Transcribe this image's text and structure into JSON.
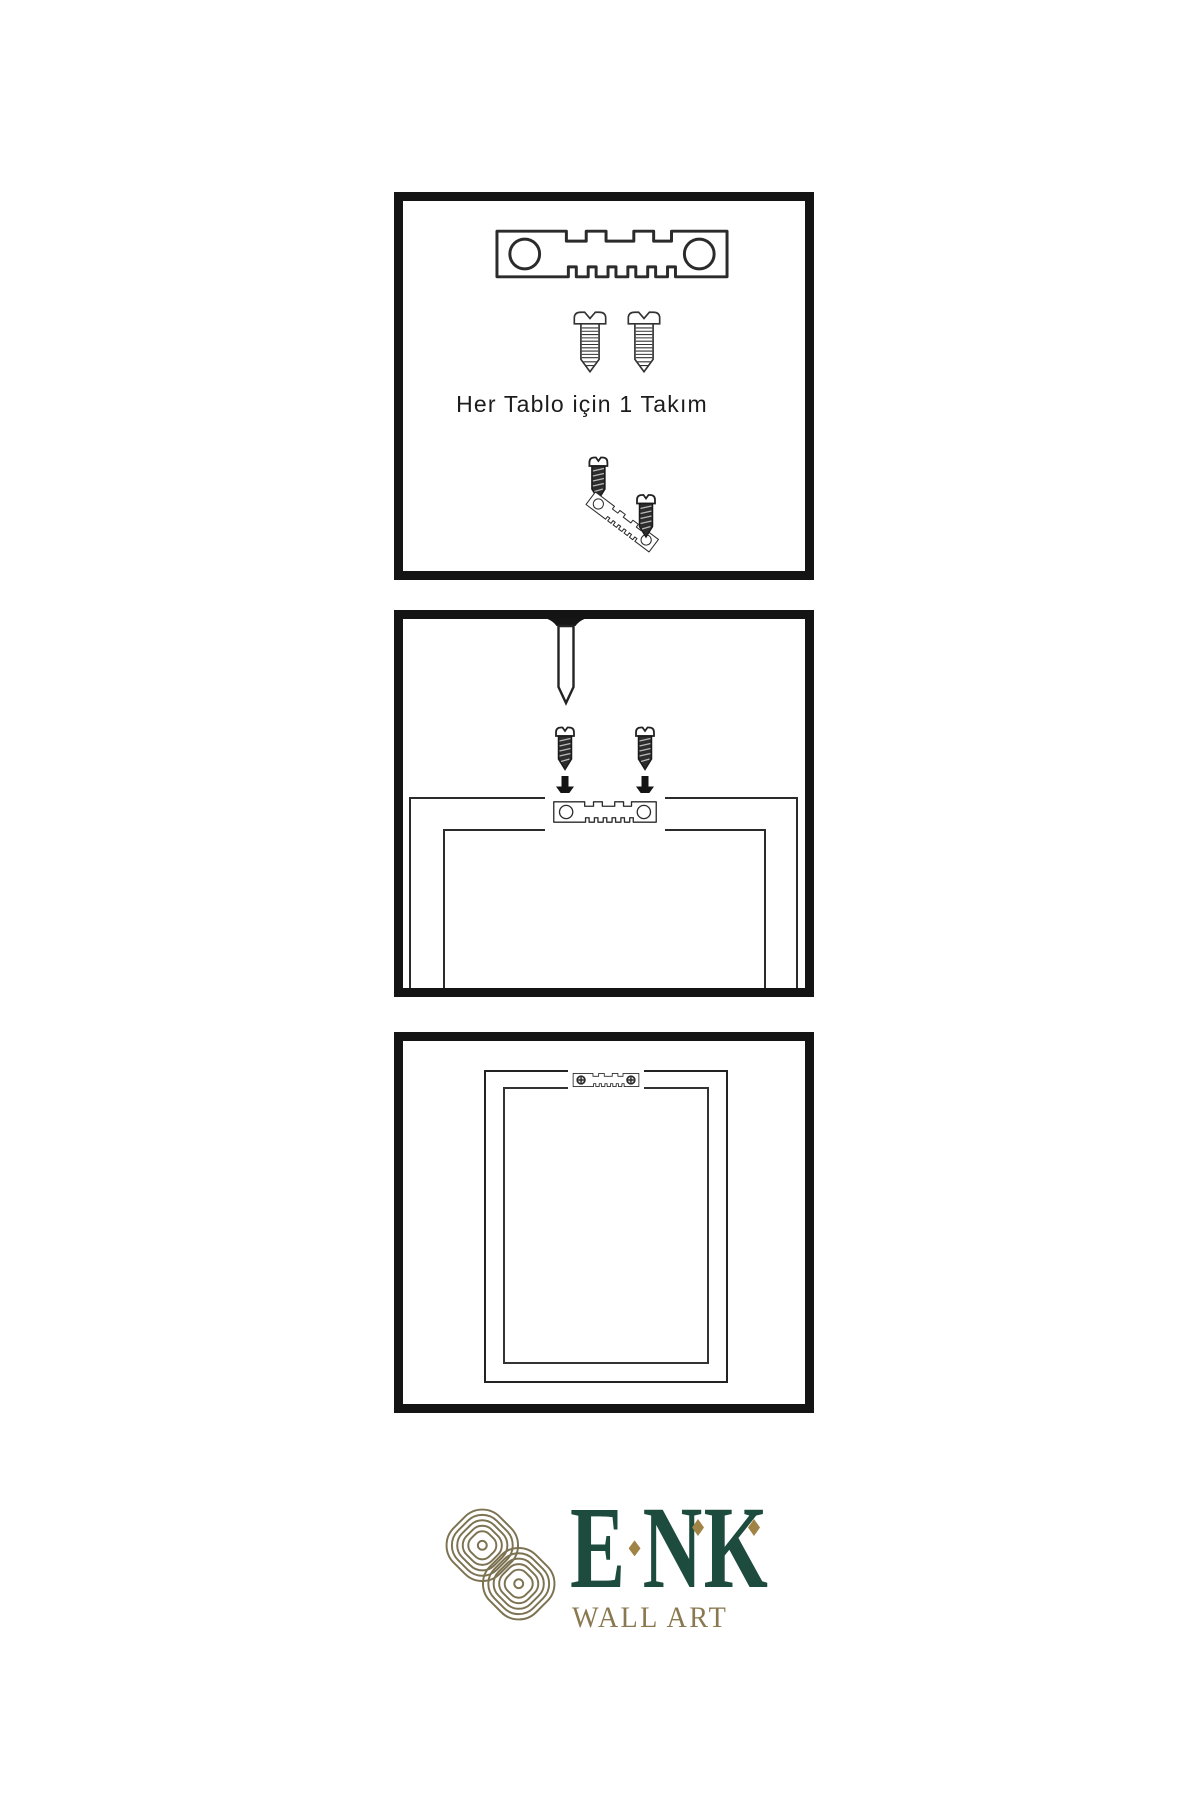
{
  "instruction_panels": {
    "panel1": {
      "caption": "Her Tablo için 1 Takım",
      "icons": [
        "sawtooth-hanger",
        "screw",
        "screw",
        "tilted-hanger-with-screws"
      ]
    },
    "panel2": {
      "icons": [
        "wall-nail",
        "screw-with-down-arrow",
        "screw-with-down-arrow",
        "frame-back-with-sawtooth-hanger"
      ]
    },
    "panel3": {
      "icons": [
        "hung-frame-with-sawtooth-hanger-and-screws"
      ]
    }
  },
  "logo": {
    "brand_letters": [
      "E",
      "N",
      "K"
    ],
    "tagline": "WALL ART",
    "mark": "interlaced-knot",
    "colors": {
      "brand_green": "#1d4b3e",
      "brand_gold": "#8a7950",
      "diamond_gold": "#a08445",
      "knot_gold": "#7d7352"
    }
  },
  "colors": {
    "background": "#ffffff",
    "ink": "#141414",
    "line": "#2b2b2b"
  }
}
